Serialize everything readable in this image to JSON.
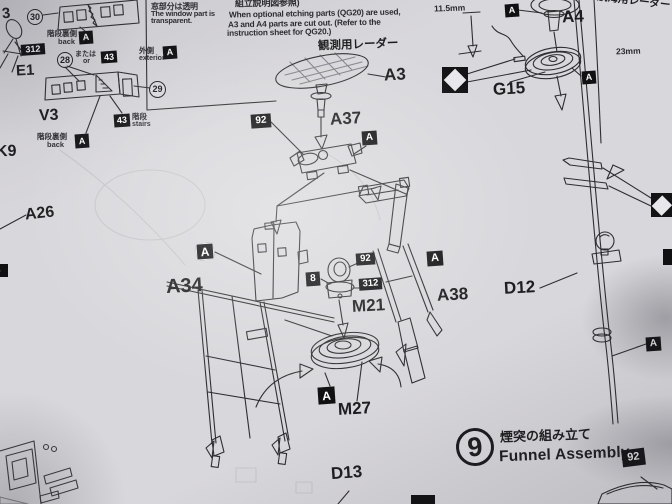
{
  "colors": {
    "paper": "#d8d7db",
    "ink": "#1d1d1f",
    "ink2": "#2e2e31",
    "badge": "#101012",
    "part_dark": "#3c3c41"
  },
  "labels": {
    "p3": "3",
    "e1": "E1",
    "v3": "V3",
    "k9": "K9",
    "a26": "A26",
    "a3": "A3",
    "a37": "A37",
    "a34": "A34",
    "a38": "A38",
    "m21": "M21",
    "m27": "M27",
    "d13": "D13",
    "d12": "D12",
    "a4": "A4",
    "g15": "G15"
  },
  "badges": {
    "a": "A",
    "p92": "92",
    "p312": "312",
    "p43": "43",
    "p8": "8",
    "p6": "6"
  },
  "circled": {
    "n30": "30",
    "n28": "28",
    "n29": "29"
  },
  "notes": {
    "window_jp": "窓部分は透明",
    "window_en1": "The window part is",
    "window_en2": "transparent.",
    "etch_jp": "組立説明図参照)",
    "etch_en1": "When optional etching parts (QG20) are used,",
    "etch_en2": "A3 and A4 parts are cut out.  (Refer to the",
    "etch_en3": "instruction sheet for QG20.)",
    "obs_radar": "観測用レーダー",
    "nav_radar": "航海用レーダー",
    "back_jp": "階段裏側",
    "back_en": "back",
    "or_jp": "または",
    "or_en": "or",
    "exterior_jp": "外側",
    "exterior_en": "exterior",
    "stairs_jp": "階段",
    "stairs_en": "stairs",
    "dim115": "11.5mm",
    "dim23": "23mm"
  },
  "section": {
    "num": "9",
    "title_jp": "煙突の組み立て",
    "title_en": "Funnel Assembly",
    "paint": "92"
  }
}
